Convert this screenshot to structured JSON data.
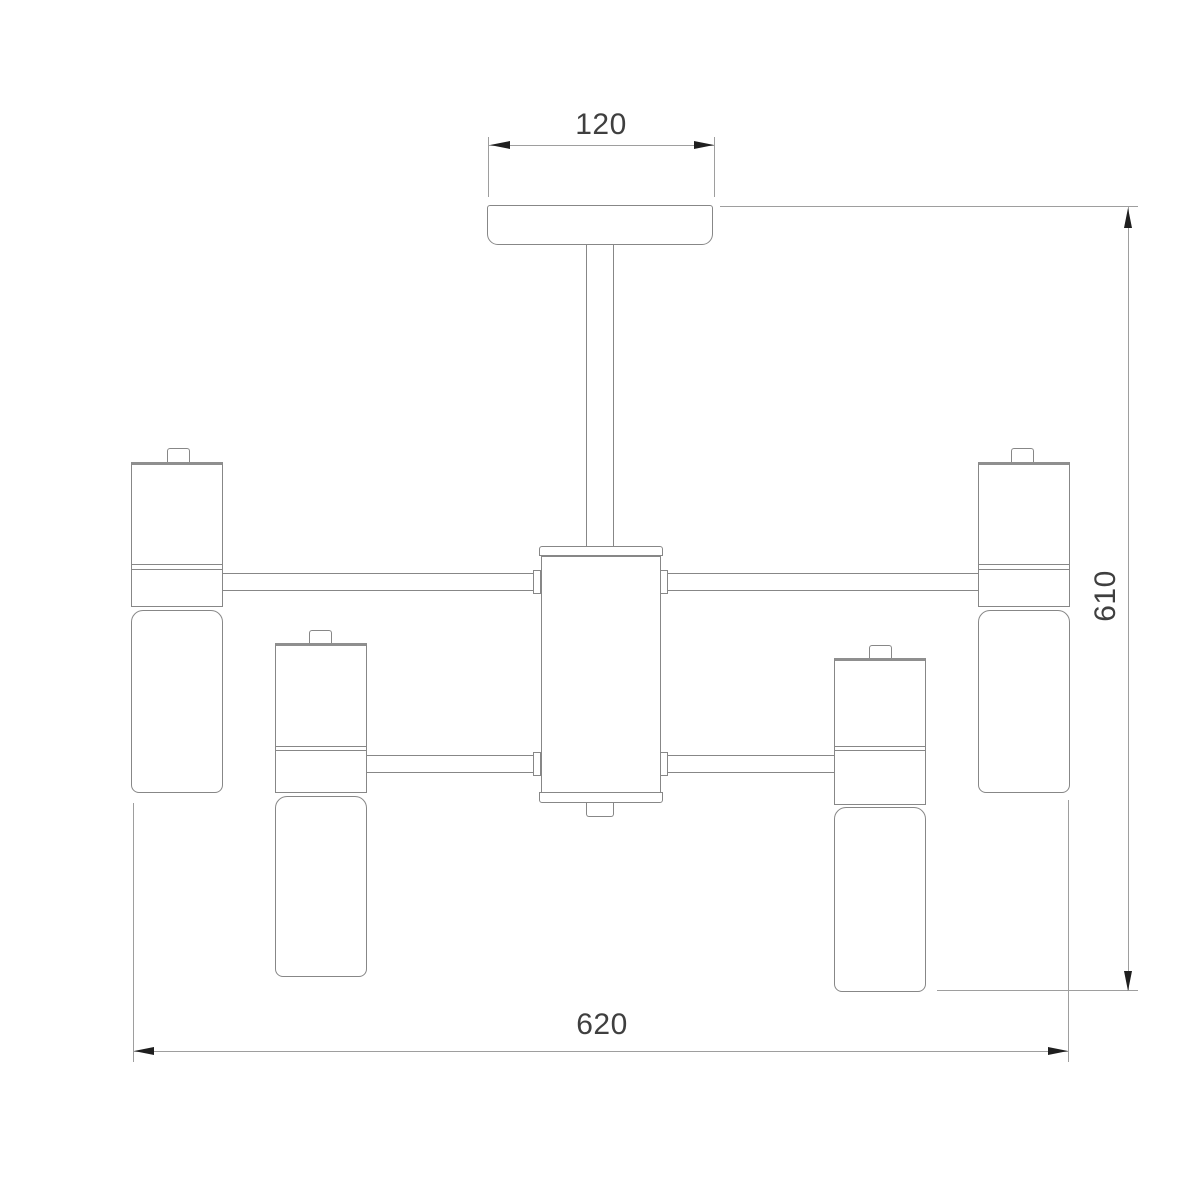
{
  "dimensions": {
    "canopy_width": "120",
    "overall_height": "610",
    "overall_width": "620"
  },
  "colors": {
    "background": "#ffffff",
    "part_outline": "#878787",
    "dimension_line": "#9e9e9e",
    "label_text": "#3f3f3f",
    "arrowhead": "#1f1f1f"
  }
}
